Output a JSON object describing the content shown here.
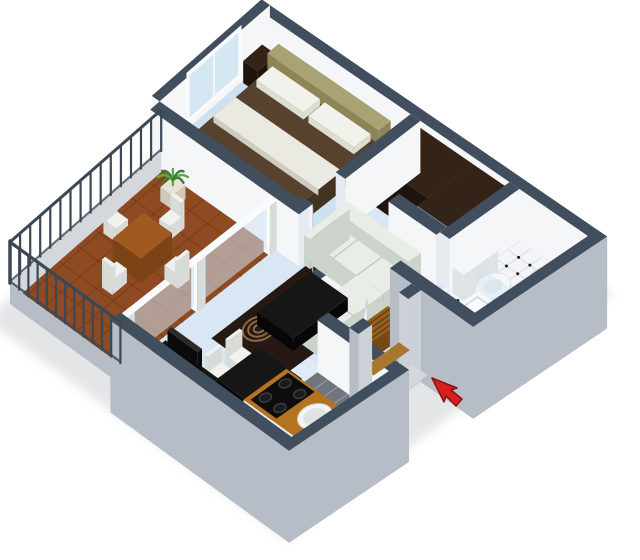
{
  "image": {
    "title": "3D isometric floor plan of a one-bedroom apartment",
    "width": 640,
    "height": 560,
    "background": "#ffffff"
  },
  "colors": {
    "background": "#ffffff",
    "shadow": "#8f969e",
    "wallTop": "#414e5e",
    "wallInner": "#f4f6f8",
    "wallShade": "#e6ebf1",
    "wallOuter": "#b7bdc6",
    "wallOuterLight": "#ccd1d8",
    "slab": "#d4d8dd",
    "floorMain": "#d8e7f3",
    "floorBedroom": "#cde1f0",
    "floorKitchen": "#dfecf6",
    "bathFloor": "#f3f5f7",
    "bathGrid": "#d8dde2",
    "bathDot": "#1d1d1d",
    "balconyTile": "#8e4a22",
    "balconyTileLine": "#6b3413",
    "glass": "#cfe4f2",
    "mirror": "#b9d6ea",
    "railing": "#3c4755",
    "bedSpread": "#56422d",
    "bedSide": "#443322",
    "pillow": "#f2f2ec",
    "pillowSide": "#ddddd2",
    "headboard": "#a9a274",
    "headboardSide": "#8d8557",
    "sofaTop": "#e9ede7",
    "sofaSide": "#cbd3cb",
    "sofaSeam": "#c2ccc2",
    "rug": "#261812",
    "rugMotif": "#8a6a44",
    "blackTop": "#161616",
    "blackSide": "#070707",
    "tvBlack": "#0b0b0b",
    "tvTop": "#2a2a2a",
    "darkWoodTop": "#342317",
    "darkWoodSide": "#1f140d",
    "counterWood": "#b4741f",
    "counterSide": "#edeff1",
    "benchWood": "#92601e",
    "benchSide": "#744a14",
    "benchSlat": "#5e3a0e",
    "thresholdWood": "#a9762e",
    "stove": "#0d0d0d",
    "burner": "#3c3c3c",
    "burnerFill": "#1b1b1b",
    "sinkWhite": "#f3f5f4",
    "sinkInner": "#dfe4e2",
    "sinkRim": "#c7ccc8",
    "tileGray": "#70767e",
    "tileGrout": "#9aa1a9",
    "doorWhite": "#fafbfc",
    "doorEdge": "#c7ccd2",
    "toiletWhite": "#f5f7f8",
    "toiletShade": "#dde3e7",
    "fixtureShade": "#e3e8ec",
    "tubInner": "#f8fafb",
    "tubEdge": "#d0d7db",
    "woodTable": "#a05a20",
    "woodTableSide": "#7c4416",
    "chairWhiteTop": "#f1f2ef",
    "chairWhiteSide": "#d8dcd8",
    "plantGreen": "#3e7d32",
    "plantGreenLight": "#62a748",
    "potTop": "#e6e2d6",
    "potSide": "#cfc9ba",
    "arrowRed": "#d61f1f",
    "arrowEdge": "#8e0f0f"
  },
  "rooms": [
    {
      "id": "balcony",
      "label": "Balcony",
      "features": [
        "metal-railing",
        "terracotta-tile-floor",
        "wooden-bistro-table",
        "four-folding-chairs",
        "potted-plant"
      ]
    },
    {
      "id": "bedroom",
      "label": "Bedroom",
      "features": [
        "double-bed-brown-spread",
        "olive-headboard",
        "two-white-pillows",
        "white-throw",
        "nightstand-left",
        "nightstand-right",
        "foot-bench",
        "corner-window"
      ]
    },
    {
      "id": "living-room",
      "label": "Living room",
      "features": [
        "white-l-shaped-sofa",
        "dark-spiral-rug",
        "black-coffee-table",
        "black-dining-table",
        "three-white-chairs",
        "tv-console",
        "flat-tv",
        "white-media-shelf",
        "glass-slider-to-balcony"
      ]
    },
    {
      "id": "hallway",
      "label": "Hallway",
      "features": [
        "dark-wardrobe",
        "mirrored-sliding-closet",
        "dark-dresser",
        "wooden-slat-bench",
        "interior-doors"
      ]
    },
    {
      "id": "bathroom",
      "label": "Bathroom",
      "features": [
        "toilet",
        "pedestal-washbasin",
        "bathtub",
        "glass-shower-screen",
        "black-dot-checkered-tile-floor"
      ]
    },
    {
      "id": "kitchen",
      "label": "Kitchen",
      "features": [
        "wood-countertop",
        "round-white-sink",
        "black-cooktop-four-burners",
        "gray-tile-strip"
      ]
    },
    {
      "id": "entrance",
      "label": "Entrance",
      "features": [
        "open-front-door",
        "wood-threshold",
        "entry-step",
        "red-direction-arrow"
      ]
    }
  ],
  "annotations": {
    "entrance_arrow": {
      "shape": "arrow",
      "direction": "up-left",
      "meaning": "apartment entrance"
    }
  }
}
